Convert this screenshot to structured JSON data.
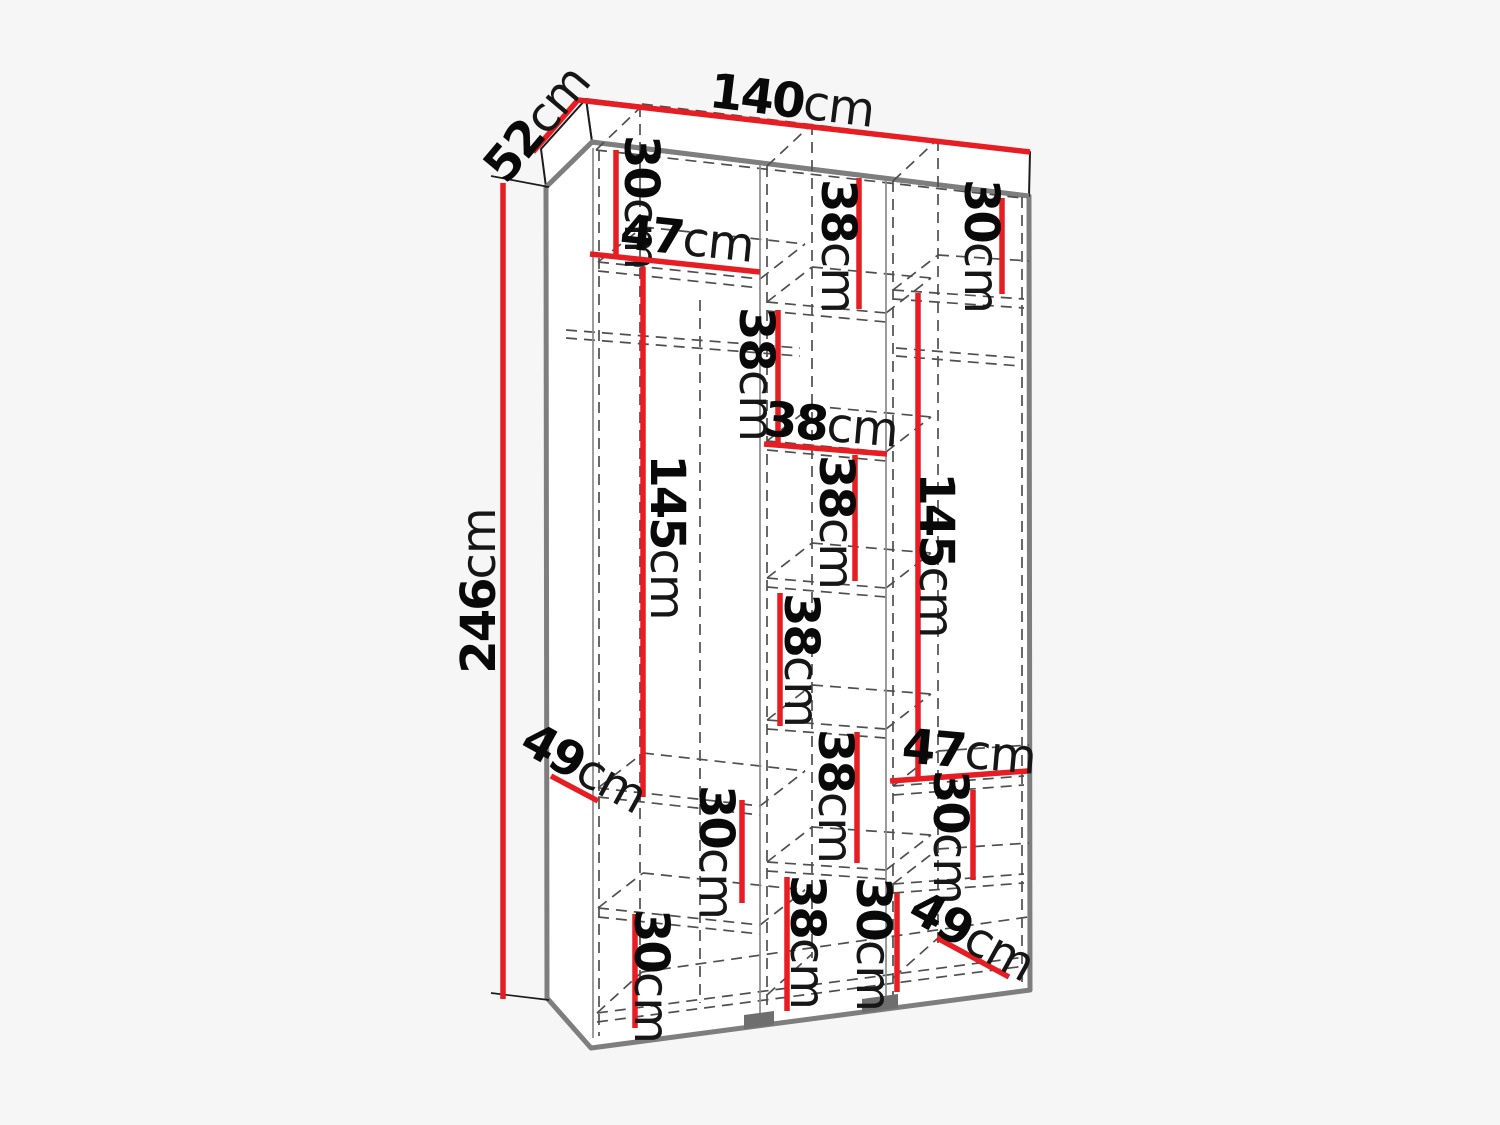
{
  "meta": {
    "description": "Technical dimension diagram of a three-section wardrobe shown in perspective with internal shelf measurements"
  },
  "canvas": {
    "width": 1500,
    "height": 1125,
    "background": "#f6f6f6"
  },
  "colors": {
    "red": "#e61e23",
    "outline_gray": "#7e7e7e",
    "thin_black": "#1c1c1c",
    "inner_gray": "#8a8a8a",
    "dash_gray": "#4f4f4f",
    "feet_gray": "#6e6e6e",
    "face_white": "#ffffff",
    "text_black": "#090909"
  },
  "drawing": {
    "carcass_outline": [
      [
        546,
        187
      ],
      [
        592,
        142
      ],
      [
        1029,
        196
      ],
      [
        1030,
        990
      ],
      [
        591,
        1048
      ],
      [
        547,
        998
      ]
    ],
    "slab_top_face": [
      [
        586,
        99
      ],
      [
        1030,
        152
      ],
      [
        1029,
        196
      ],
      [
        592,
        142
      ]
    ],
    "slab_left_face": [
      [
        586,
        99
      ],
      [
        541,
        149
      ],
      [
        546,
        187
      ],
      [
        592,
        142
      ]
    ],
    "feet": [
      [
        [
          744,
          1015
        ],
        [
          774,
          1011
        ],
        [
          774,
          1025
        ],
        [
          744,
          1029
        ]
      ],
      [
        [
          862,
          999
        ],
        [
          898,
          994
        ],
        [
          898,
          1008
        ],
        [
          862,
          1013
        ]
      ]
    ],
    "inner_solid_lines": [
      [
        593,
        148,
        593,
        1038
      ],
      [
        760,
        165,
        760,
        1018
      ],
      [
        886,
        180,
        886,
        1003
      ]
    ],
    "witness_lines": [
      [
        491,
        176,
        549,
        187
      ],
      [
        491,
        993,
        549,
        1000
      ]
    ],
    "dashed_lines": [
      [
        599,
        150,
        599,
        1036
      ],
      [
        767,
        166,
        767,
        1016
      ],
      [
        893,
        181,
        893,
        1001
      ],
      [
        1022,
        197,
        1022,
        988
      ],
      [
        640,
        106,
        640,
        985
      ],
      [
        700,
        300,
        700,
        1003
      ],
      [
        812,
        124,
        812,
        958
      ],
      [
        938,
        140,
        938,
        943
      ],
      [
        596,
        150,
        1022,
        198
      ],
      [
        642,
        104,
        1028,
        151
      ],
      [
        596,
        150,
        642,
        106
      ],
      [
        767,
        166,
        812,
        124
      ],
      [
        893,
        181,
        938,
        139
      ],
      [
        597,
        1013,
        1025,
        957
      ],
      [
        597,
        1022,
        1025,
        966
      ],
      [
        642,
        972,
        1028,
        917
      ],
      [
        597,
        1013,
        642,
        972
      ],
      [
        767,
        995,
        812,
        954
      ],
      [
        893,
        978,
        938,
        938
      ],
      [
        598,
        262,
        760,
        279
      ],
      [
        598,
        271,
        760,
        288
      ],
      [
        643,
        227,
        805,
        244
      ],
      [
        598,
        262,
        643,
        227
      ],
      [
        760,
        279,
        805,
        244
      ],
      [
        598,
        788,
        760,
        806
      ],
      [
        598,
        797,
        760,
        815
      ],
      [
        643,
        753,
        805,
        771
      ],
      [
        598,
        788,
        643,
        753
      ],
      [
        760,
        806,
        805,
        771
      ],
      [
        598,
        908,
        760,
        925
      ],
      [
        598,
        917,
        760,
        934
      ],
      [
        643,
        873,
        805,
        890
      ],
      [
        598,
        908,
        643,
        873
      ],
      [
        760,
        925,
        805,
        890
      ],
      [
        566,
        330,
        800,
        348
      ],
      [
        566,
        338,
        800,
        356
      ],
      [
        767,
        302,
        886,
        313
      ],
      [
        767,
        311,
        886,
        322
      ],
      [
        812,
        267,
        931,
        278
      ],
      [
        767,
        302,
        812,
        267
      ],
      [
        886,
        313,
        931,
        278
      ],
      [
        767,
        441,
        886,
        452
      ],
      [
        767,
        450,
        886,
        461
      ],
      [
        812,
        406,
        931,
        417
      ],
      [
        767,
        441,
        812,
        406
      ],
      [
        886,
        452,
        931,
        417
      ],
      [
        767,
        578,
        886,
        588
      ],
      [
        767,
        587,
        886,
        597
      ],
      [
        812,
        543,
        931,
        553
      ],
      [
        767,
        578,
        812,
        543
      ],
      [
        886,
        588,
        931,
        553
      ],
      [
        767,
        720,
        886,
        729
      ],
      [
        767,
        729,
        886,
        738
      ],
      [
        812,
        685,
        931,
        694
      ],
      [
        767,
        720,
        812,
        685
      ],
      [
        886,
        729,
        931,
        694
      ],
      [
        767,
        862,
        886,
        870
      ],
      [
        767,
        871,
        886,
        879
      ],
      [
        812,
        827,
        931,
        835
      ],
      [
        767,
        862,
        812,
        827
      ],
      [
        886,
        870,
        931,
        835
      ],
      [
        893,
        290,
        1024,
        299
      ],
      [
        893,
        299,
        1024,
        308
      ],
      [
        938,
        255,
        1029,
        261
      ],
      [
        893,
        290,
        938,
        255
      ],
      [
        896,
        348,
        1020,
        358
      ],
      [
        896,
        356,
        1020,
        366
      ],
      [
        893,
        786,
        1024,
        776
      ],
      [
        893,
        795,
        1024,
        785
      ],
      [
        938,
        751,
        1029,
        745
      ],
      [
        893,
        786,
        938,
        751
      ],
      [
        893,
        884,
        1024,
        874
      ],
      [
        893,
        893,
        1024,
        883
      ],
      [
        938,
        849,
        1029,
        843
      ],
      [
        893,
        884,
        938,
        849
      ]
    ]
  },
  "dimensions": [
    {
      "value": "52",
      "unit": "cm",
      "line": [
        533,
        152,
        578,
        100
      ],
      "label": {
        "x": 537,
        "y": 124,
        "rot": -50,
        "size": 48
      }
    },
    {
      "value": "140",
      "unit": "cm",
      "line": [
        578,
        100,
        1030,
        152
      ],
      "label": {
        "x": 792,
        "y": 101,
        "rot": 7,
        "size": 48
      }
    },
    {
      "value": "246",
      "unit": "cm",
      "line": [
        503,
        183,
        503,
        999
      ],
      "label": {
        "x": 479,
        "y": 591,
        "rot": -90,
        "size": 48
      }
    },
    {
      "value": "30",
      "unit": "cm",
      "line": [
        616,
        150,
        616,
        256
      ],
      "label": {
        "x": 641,
        "y": 202,
        "rot": 90,
        "size": 48
      }
    },
    {
      "value": "47",
      "unit": "cm",
      "line": [
        590,
        254,
        760,
        272
      ],
      "label": {
        "x": 687,
        "y": 239,
        "rot": 6,
        "size": 48
      }
    },
    {
      "value": "145",
      "unit": "cm",
      "line": [
        643,
        267,
        643,
        797
      ],
      "label": {
        "x": 667,
        "y": 537,
        "rot": 90,
        "size": 48
      }
    },
    {
      "value": "49",
      "unit": "cm",
      "line": [
        551,
        776,
        598,
        801
      ],
      "label": {
        "x": 584,
        "y": 768,
        "rot": 29,
        "size": 48
      }
    },
    {
      "value": "30",
      "unit": "cm",
      "line": [
        742,
        800,
        742,
        903
      ],
      "label": {
        "x": 716,
        "y": 852,
        "rot": 90,
        "size": 48
      }
    },
    {
      "value": "30",
      "unit": "cm",
      "line": [
        635,
        914,
        635,
        1028
      ],
      "label": {
        "x": 651,
        "y": 976,
        "rot": 90,
        "size": 48
      }
    },
    {
      "value": "38",
      "unit": "cm",
      "line": [
        859,
        178,
        859,
        309
      ],
      "label": {
        "x": 838,
        "y": 246,
        "rot": 90,
        "size": 48
      }
    },
    {
      "value": "38",
      "unit": "cm",
      "line": [
        778,
        310,
        778,
        443
      ],
      "label": {
        "x": 756,
        "y": 374,
        "rot": 90,
        "size": 48
      }
    },
    {
      "value": "38",
      "unit": "cm",
      "line": [
        764,
        444,
        887,
        454
      ],
      "label": {
        "x": 831,
        "y": 425,
        "rot": 5,
        "size": 48
      }
    },
    {
      "value": "38",
      "unit": "cm",
      "line": [
        855,
        455,
        855,
        581
      ],
      "label": {
        "x": 836,
        "y": 522,
        "rot": 90,
        "size": 48
      }
    },
    {
      "value": "38",
      "unit": "cm",
      "line": [
        780,
        593,
        780,
        726
      ],
      "label": {
        "x": 801,
        "y": 660,
        "rot": 90,
        "size": 48
      }
    },
    {
      "value": "38",
      "unit": "cm",
      "line": [
        857,
        732,
        857,
        863
      ],
      "label": {
        "x": 835,
        "y": 796,
        "rot": 90,
        "size": 48
      }
    },
    {
      "value": "38",
      "unit": "cm",
      "line": [
        787,
        877,
        787,
        1011
      ],
      "label": {
        "x": 807,
        "y": 942,
        "rot": 90,
        "size": 48
      }
    },
    {
      "value": "30",
      "unit": "cm",
      "line": [
        897,
        893,
        897,
        992
      ],
      "label": {
        "x": 873,
        "y": 944,
        "rot": 90,
        "size": 48
      }
    },
    {
      "value": "30",
      "unit": "cm",
      "line": [
        1002,
        198,
        1002,
        294
      ],
      "label": {
        "x": 981,
        "y": 246,
        "rot": 90,
        "size": 48
      }
    },
    {
      "value": "145",
      "unit": "cm",
      "line": [
        918,
        293,
        918,
        778
      ],
      "label": {
        "x": 936,
        "y": 555,
        "rot": 90,
        "size": 48
      }
    },
    {
      "value": "47",
      "unit": "cm",
      "line": [
        890,
        781,
        1028,
        771
      ],
      "label": {
        "x": 969,
        "y": 752,
        "rot": 5,
        "size": 48
      }
    },
    {
      "value": "30",
      "unit": "cm",
      "line": [
        973,
        790,
        973,
        880
      ],
      "label": {
        "x": 950,
        "y": 837,
        "rot": 90,
        "size": 48
      }
    },
    {
      "value": "49",
      "unit": "cm",
      "line": [
        937,
        938,
        1009,
        977
      ],
      "label": {
        "x": 972,
        "y": 936,
        "rot": 29,
        "size": 48
      }
    }
  ]
}
